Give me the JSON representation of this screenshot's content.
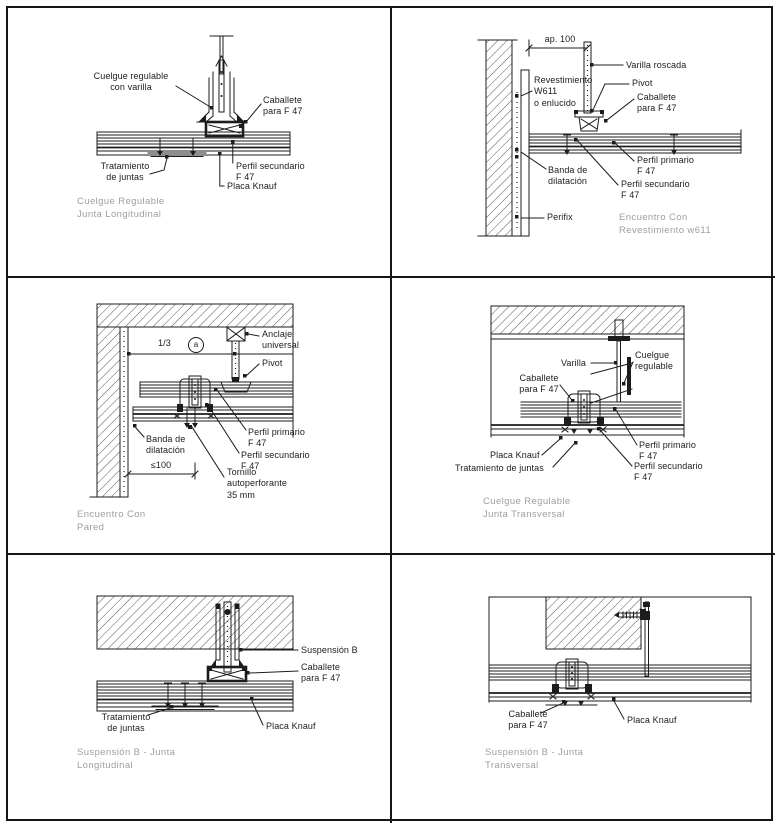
{
  "sheet": {
    "background": "#ffffff",
    "line_color": "#1c1c1c",
    "caption_color": "#9e9e9e",
    "description": "Knauf F47 suspended ceiling construction details, 6 panels"
  },
  "panels": [
    {
      "caption": "Cuelgue Regulable\nJunta Longitudinal",
      "labels": {
        "cuelgue": "Cuelgue regulable\ncon varilla",
        "caballete": "Caballete\npara F 47",
        "tratamiento": "Tratamiento\nde juntas",
        "perfil_secundario": "Perfil secundario\nF 47",
        "placa": "Placa Knauf"
      }
    },
    {
      "caption": "Encuentro Con\nRevestimiento w611",
      "labels": {
        "dim": "ap. 100",
        "varilla_roscada": "Varilla roscada",
        "revestimiento": "Revestimiento\nW611\no enlucido",
        "pivot": "Pivot",
        "caballete": "Caballete\npara F 47",
        "banda": "Banda de\ndilatación",
        "perfil_primario": "Perfil primario\nF 47",
        "perfil_secundario": "Perfil secundario\nF 47",
        "perifix": "Perifix"
      }
    },
    {
      "caption": "Encuentro Con\nPared",
      "labels": {
        "dim_ratio": "1/3",
        "dim_ratio_ref": "a",
        "anclaje": "Anclaje\nuniversal",
        "pivot": "Pivot",
        "banda": "Banda de\ndilatación",
        "dim_max": "≤100",
        "perfil_primario": "Perfil primario\nF 47",
        "perfil_secundario": "Perfil secundario\nF 47",
        "tornillo": "Tornillo\nautoperforante\n35 mm"
      }
    },
    {
      "caption": "Cuelgue Regulable\nJunta Transversal",
      "labels": {
        "varilla": "Varilla",
        "cuelgue": "Cuelgue\nregulable",
        "caballete": "Caballete\npara F 47",
        "placa": "Placa Knauf",
        "tratamiento": "Tratamiento de juntas",
        "perfil_primario": "Perfil primario\nF 47",
        "perfil_secundario": "Perfil secundario\nF 47"
      }
    },
    {
      "caption": "Suspensión B - Junta\nLongitudinal",
      "labels": {
        "suspension": "Suspensión B",
        "caballete": "Caballete\npara F 47",
        "tratamiento": "Tratamiento\nde juntas",
        "placa": "Placa Knauf"
      }
    },
    {
      "caption": "Suspensión B - Junta\nTransversal",
      "labels": {
        "caballete": "Caballete\npara F 47",
        "placa": "Placa Knauf"
      }
    }
  ]
}
